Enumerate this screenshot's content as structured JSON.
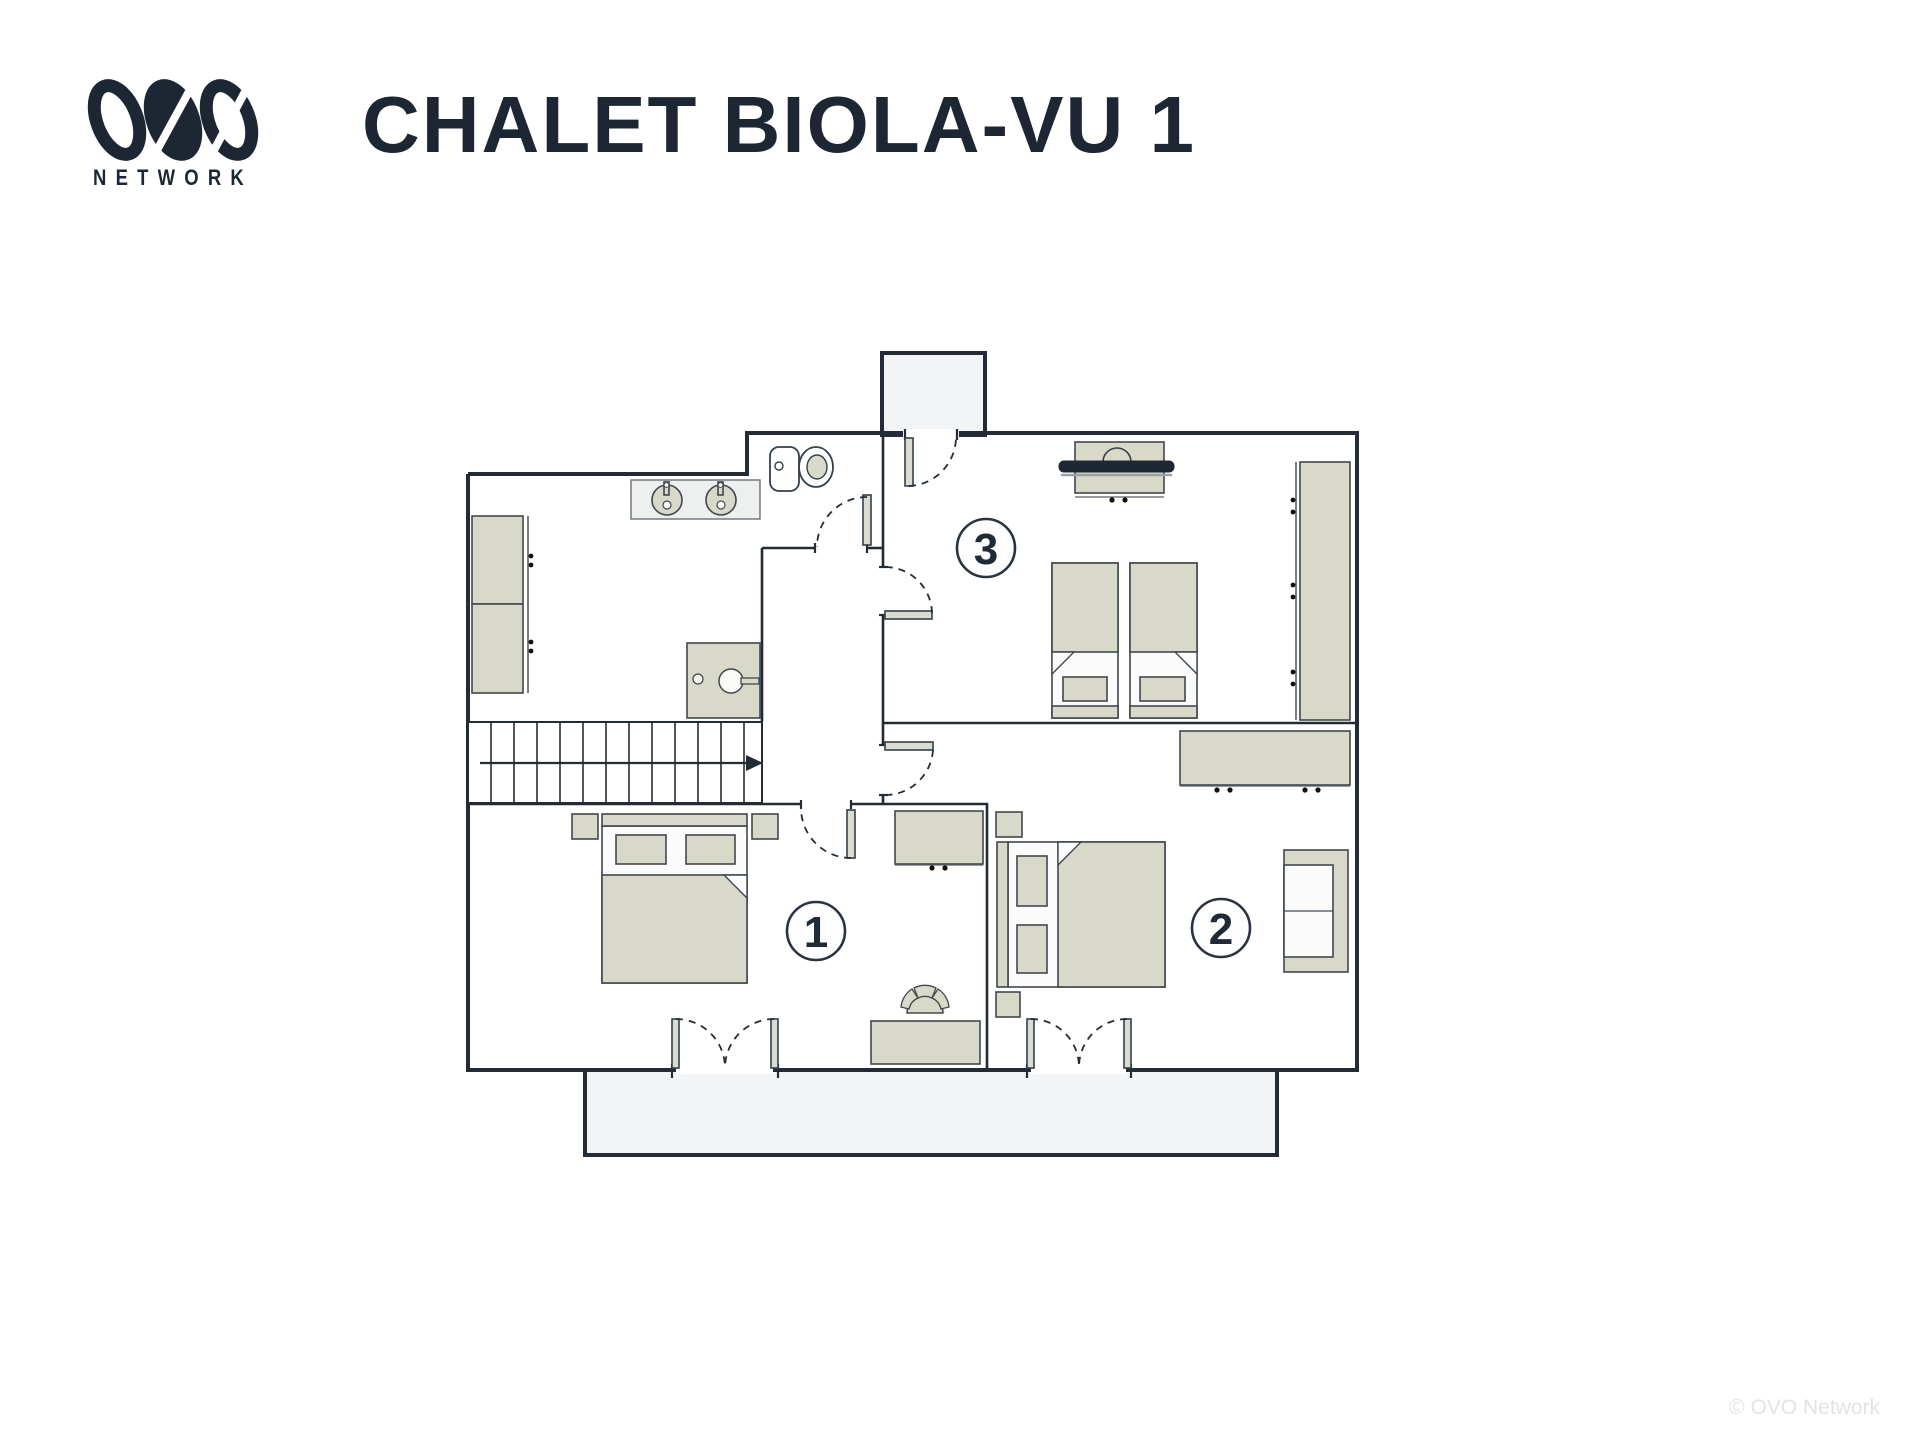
{
  "brand": {
    "logo": "OVO",
    "subtitle": "NETWORK"
  },
  "title": "CHALET BIOLA-VU 1",
  "rooms": [
    {
      "number": "1",
      "name": "bedroom-1",
      "furniture": [
        "double-bed",
        "nightstand",
        "nightstand",
        "desk",
        "chair",
        "dresser",
        "french-door-to-balcony"
      ]
    },
    {
      "number": "2",
      "name": "bedroom-2",
      "furniture": [
        "double-bed",
        "nightstand",
        "nightstand",
        "desk",
        "sofa",
        "french-door-to-balcony"
      ]
    },
    {
      "number": "3",
      "name": "bedroom-3",
      "furniture": [
        "single-bed",
        "single-bed",
        "tv-unit",
        "wardrobe",
        "desk",
        "door-to-balcony"
      ]
    }
  ],
  "bathroom": {
    "fixtures": [
      "double-sink-vanity",
      "toilet",
      "shower",
      "wardrobe",
      "wardrobe"
    ]
  },
  "stairs": {
    "direction": "up-right-arrow"
  },
  "balconies": [
    "top-balcony",
    "bottom-balcony"
  ],
  "footer": {
    "copyright": "© OVO Network"
  },
  "colors": {
    "ink": "#232c36",
    "furniture_beige": "#d9d9c9",
    "balcony_gray": "#f3f4f5",
    "title_navy": "#1c2733",
    "watermark_gray": "#e3e3e5"
  }
}
